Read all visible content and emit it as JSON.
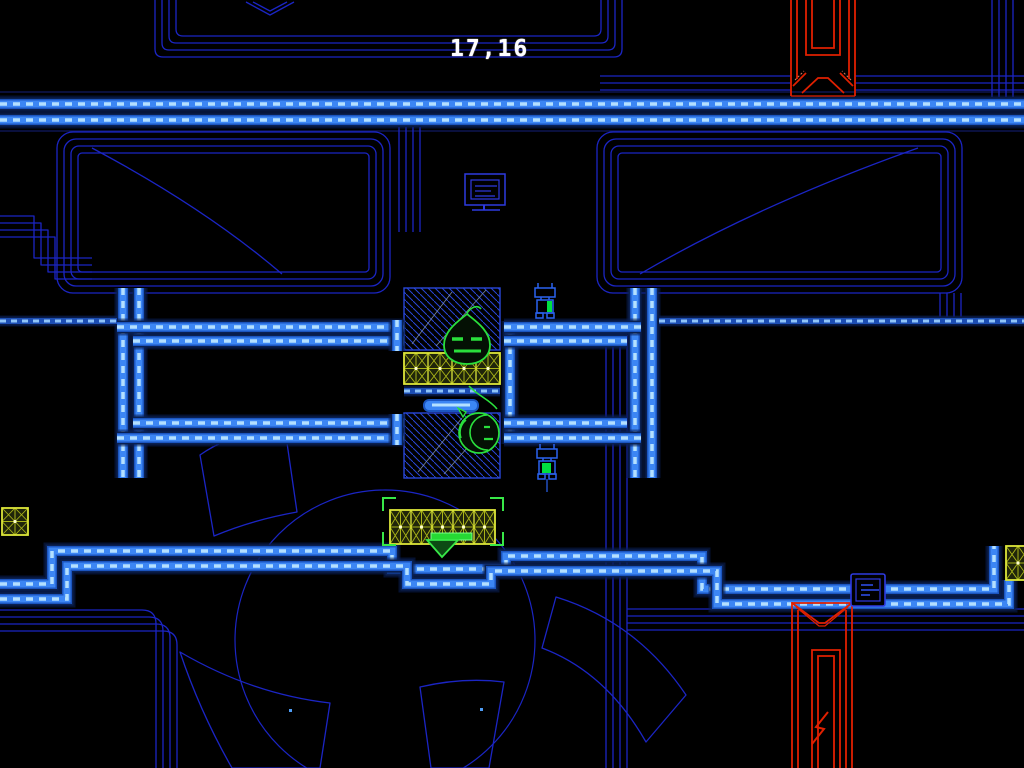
{
  "hud": {
    "coordinates": "17,16"
  },
  "scene": {
    "objects": [
      {
        "name": "red-door-top",
        "type": "door",
        "color": "red"
      },
      {
        "name": "red-door-bottom",
        "type": "door",
        "color": "red",
        "glyph": "lightning-zigzag"
      },
      {
        "name": "flame-enemy",
        "type": "enemy",
        "color": "green"
      },
      {
        "name": "blob-enemy",
        "type": "enemy",
        "color": "green"
      },
      {
        "name": "robot-turret-upper",
        "type": "robot",
        "color": "blue-green"
      },
      {
        "name": "robot-turret-lower",
        "type": "robot",
        "color": "blue-green"
      },
      {
        "name": "destructible-block-grid-mid",
        "type": "block-grid"
      },
      {
        "name": "destructible-block-grid-bottom",
        "type": "block-grid",
        "targeted": true
      },
      {
        "name": "destructible-block-left-edge",
        "type": "block-grid"
      },
      {
        "name": "destructible-block-right-edge",
        "type": "block-grid"
      },
      {
        "name": "hatched-panel-top",
        "type": "hatched-panel"
      },
      {
        "name": "hatched-panel-bottom",
        "type": "hatched-panel"
      },
      {
        "name": "sign-panel",
        "type": "sign"
      },
      {
        "name": "terminal-panel",
        "type": "terminal"
      }
    ]
  },
  "palette": {
    "background": "#000000",
    "wall_glow": "#0a1f55",
    "wall_base": "#1b55c0",
    "wall_core": "#3c86f4",
    "wall_dash": "#b4e0ff",
    "thin_line": "#1b25c4",
    "thin_line_bright": "#2e3ae0",
    "hatch_line": "#2946d8",
    "scratch": "#8fa0b8",
    "door_red": "#e02000",
    "door_red_soft": "#d87a5e",
    "block_border": "#dde63a",
    "block_line": "#a9b318",
    "block_fill": "#20250a",
    "block_dot": "#ffffd0",
    "enemy_green": "#2ae03c",
    "target_green": "#38e848",
    "item_green": "#26d934",
    "item_green_hi": "#7dff8a",
    "robot_blue": "#2a63f0",
    "robot_green": "#00e040",
    "dot_blue": "#4f9df6",
    "hud_text": "#ffffff"
  }
}
